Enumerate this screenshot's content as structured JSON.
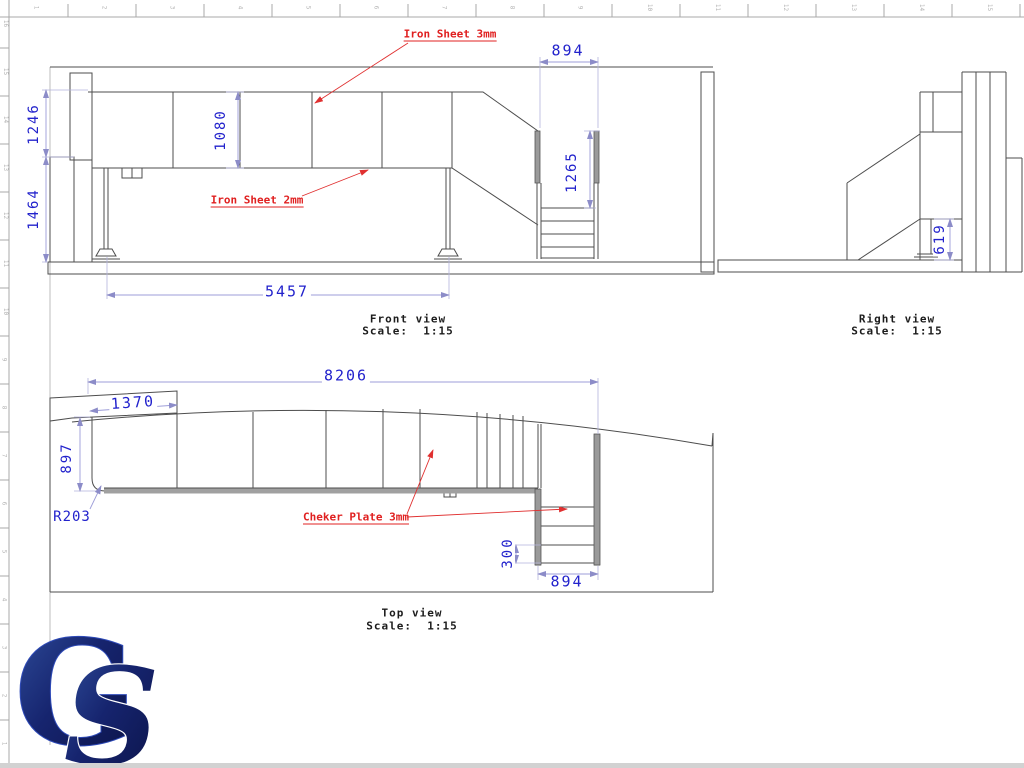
{
  "colors": {
    "line": "#4d4d4d",
    "gray_fill": "#9a9a9a",
    "dim_text": "#2222cc",
    "dim_line": "#9c9cd8",
    "annotation_red": "#e02020",
    "ruler": "#a8a8a8",
    "logo_blue_dark": "#0a1245",
    "logo_blue": "#31519f"
  },
  "rulers": {
    "top": [
      "1",
      "2",
      "3",
      "4",
      "5",
      "6",
      "7",
      "8",
      "9",
      "10",
      "11",
      "12",
      "13",
      "14",
      "15"
    ],
    "left": [
      "16",
      "15",
      "14",
      "13",
      "12",
      "11",
      "10",
      "9",
      "8",
      "7",
      "6",
      "5",
      "4",
      "3",
      "2",
      "1"
    ]
  },
  "front_view": {
    "caption": "Front view",
    "scale": "Scale:  1:15",
    "dims": {
      "upper_height": "1246",
      "lower_height": "1464",
      "wall_height": "1080",
      "stair_width": "894",
      "stair_height": "1265",
      "base_length": "5457"
    },
    "annotations": {
      "iron_sheet_3": "Iron Sheet 3mm",
      "iron_sheet_2": "Iron Sheet 2mm"
    }
  },
  "right_view": {
    "caption": "Right view",
    "scale": "Scale:  1:15",
    "dims": {
      "step_height": "619"
    }
  },
  "top_view": {
    "caption": "Top view",
    "scale": "Scale:  1:15",
    "dims": {
      "total_length": "8206",
      "landing_length": "1370",
      "deck_width": "897",
      "corner_radius": "R203",
      "tread_depth": "300",
      "stair_width": "894"
    },
    "annotations": {
      "cheker_plate": "Cheker Plate 3mm"
    }
  },
  "logo": {
    "letter_g": "G",
    "letter_s": "S"
  }
}
